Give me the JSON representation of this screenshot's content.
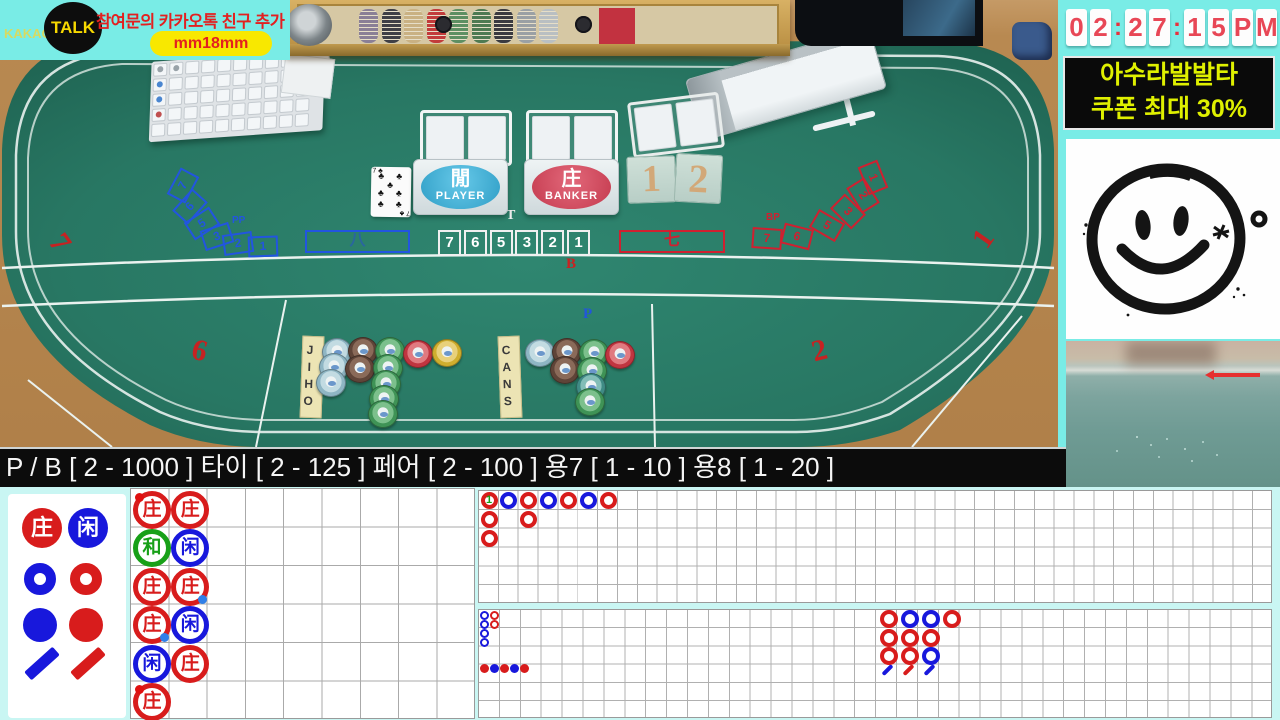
{
  "banner": {
    "kakao": "KAKAO",
    "talk": "TALK",
    "notice": "참여문의 카카오톡 친구 추가",
    "id_badge": "mm18mm"
  },
  "clock": {
    "chars": [
      "0",
      "2",
      ":",
      "2",
      "7",
      ":",
      "1",
      "5",
      "P",
      "M"
    ]
  },
  "promo": {
    "line1": "아수라발발타",
    "line2": "쿠폰 최대 30%"
  },
  "limits": {
    "text": "P / B [ 2 - 1000 ] 타이 [ 2 - 125 ] 페어 [ 2 - 100 ] 용7 [ 1 - 10 ] 용8 [ 1 - 20 ]"
  },
  "table": {
    "player": {
      "hanja": "閒",
      "label": "PLAYER"
    },
    "banker": {
      "hanja": "庄",
      "label": "BANKER"
    },
    "tie": {
      "label": "T",
      "numbers": [
        "7",
        "6",
        "5",
        "3",
        "2",
        "1"
      ]
    },
    "left_arc": {
      "label": "PP",
      "numbers": [
        "7",
        "6",
        "5",
        "3",
        "2",
        "1"
      ]
    },
    "right_arc": {
      "label": "BP",
      "numbers": [
        "1",
        "2",
        "3",
        "5",
        "6",
        "7"
      ]
    },
    "left_box": "八",
    "right_box": "七",
    "tiles": [
      "1",
      "2"
    ],
    "tags": [
      "JIHO",
      "CANS"
    ],
    "card": {
      "rank": "7",
      "suit": "♣"
    },
    "seats": [
      {
        "n": "7",
        "x": 52,
        "y": 226,
        "rot": 55
      },
      {
        "n": "6",
        "x": 192,
        "y": 334,
        "rot": 14
      },
      {
        "n": "2",
        "x": 812,
        "y": 334,
        "rot": -14
      },
      {
        "n": "1",
        "x": 976,
        "y": 222,
        "rot": -55
      }
    ],
    "region_labels": [
      {
        "n": "B",
        "x": 566,
        "y": 256,
        "color": "#cc2020"
      },
      {
        "n": "P",
        "x": 583,
        "y": 306,
        "color": "#2255dd"
      }
    ],
    "chips": [
      {
        "x": 337,
        "y": 352,
        "c": "lightblue"
      },
      {
        "x": 334,
        "y": 367,
        "c": "lightblue"
      },
      {
        "x": 331,
        "y": 383,
        "c": "lightblue"
      },
      {
        "x": 363,
        "y": 351,
        "c": "brown"
      },
      {
        "x": 360,
        "y": 369,
        "c": "brown"
      },
      {
        "x": 390,
        "y": 351,
        "c": "green"
      },
      {
        "x": 388,
        "y": 368,
        "c": "green"
      },
      {
        "x": 386,
        "y": 384,
        "c": "green"
      },
      {
        "x": 384,
        "y": 399,
        "c": "green"
      },
      {
        "x": 383,
        "y": 414,
        "c": "green"
      },
      {
        "x": 418,
        "y": 354,
        "c": "red"
      },
      {
        "x": 447,
        "y": 353,
        "c": "yellow"
      },
      {
        "x": 540,
        "y": 353,
        "c": "lightblue"
      },
      {
        "x": 567,
        "y": 352,
        "c": "brown"
      },
      {
        "x": 565,
        "y": 370,
        "c": "brown"
      },
      {
        "x": 594,
        "y": 353,
        "c": "green"
      },
      {
        "x": 592,
        "y": 371,
        "c": "green"
      },
      {
        "x": 591,
        "y": 387,
        "c": "teal"
      },
      {
        "x": 590,
        "y": 402,
        "c": "green"
      },
      {
        "x": 620,
        "y": 355,
        "c": "red"
      }
    ],
    "chip_colors": {
      "lightblue": [
        "#8fb6c4",
        "#c2dbe2"
      ],
      "brown": [
        "#5f4438",
        "#8a6a59"
      ],
      "green": [
        "#3f9356",
        "#7cc08c"
      ],
      "red": [
        "#c03540",
        "#e07a80"
      ],
      "yellow": [
        "#cfae2e",
        "#e8d07a"
      ],
      "teal": [
        "#3f8b85",
        "#82bdb7"
      ]
    }
  },
  "chip_case": {
    "stacks": [
      "#8a7f96",
      "#3f3f46",
      "#c9b183",
      "#c23b3b",
      "#5d8f62",
      "#4e7a52",
      "#3a3a40",
      "#9aa0a4",
      "#b9bfc2"
    ]
  },
  "scoreboard": {
    "colors": {
      "banker": "#d81c1c",
      "player": "#1818dc",
      "tie": "#18a018",
      "dot_blue": "#2f7fe8",
      "dot_red": "#e01010"
    },
    "legend": {
      "banker_char": "庄",
      "player_char": "闲"
    },
    "bead_road": {
      "symbols": {
        "B": "庄",
        "P": "闲",
        "T": "和"
      },
      "cells": [
        {
          "c": 0,
          "r": 0,
          "v": "B",
          "dot": "tl"
        },
        {
          "c": 0,
          "r": 1,
          "v": "T"
        },
        {
          "c": 0,
          "r": 2,
          "v": "B"
        },
        {
          "c": 0,
          "r": 3,
          "v": "B",
          "dot": "br"
        },
        {
          "c": 0,
          "r": 4,
          "v": "P"
        },
        {
          "c": 0,
          "r": 5,
          "v": "B",
          "dot": "tl"
        },
        {
          "c": 1,
          "r": 0,
          "v": "B"
        },
        {
          "c": 1,
          "r": 1,
          "v": "P"
        },
        {
          "c": 1,
          "r": 2,
          "v": "B",
          "dot": "br"
        },
        {
          "c": 1,
          "r": 3,
          "v": "P"
        },
        {
          "c": 1,
          "r": 4,
          "v": "B"
        }
      ]
    },
    "big_road": {
      "cells": [
        {
          "c": 0,
          "r": 0,
          "v": "B",
          "tie_count": "1"
        },
        {
          "c": 1,
          "r": 0,
          "v": "P"
        },
        {
          "c": 2,
          "r": 0,
          "v": "B"
        },
        {
          "c": 3,
          "r": 0,
          "v": "P"
        },
        {
          "c": 4,
          "r": 0,
          "v": "B"
        },
        {
          "c": 5,
          "r": 0,
          "v": "P"
        },
        {
          "c": 6,
          "r": 0,
          "v": "B"
        },
        {
          "c": 0,
          "r": 1,
          "v": "B"
        },
        {
          "c": 2,
          "r": 1,
          "v": "B"
        },
        {
          "c": 0,
          "r": 2,
          "v": "B"
        }
      ]
    },
    "big_eye_road": {
      "cells": [
        {
          "c": 0,
          "r": 0,
          "v": "P"
        },
        {
          "c": 0,
          "r": 1,
          "v": "P"
        },
        {
          "c": 0,
          "r": 2,
          "v": "P"
        },
        {
          "c": 0,
          "r": 3,
          "v": "P"
        },
        {
          "c": 1,
          "r": 0,
          "v": "B"
        },
        {
          "c": 1,
          "r": 1,
          "v": "B"
        }
      ]
    },
    "small_road": {
      "dots": [
        "B",
        "P",
        "B",
        "P",
        "B"
      ]
    },
    "three_road": {
      "rows": [
        [
          "B",
          "P",
          "P",
          "B"
        ],
        [
          "B",
          "B",
          "B"
        ],
        [
          "B",
          "B",
          "P"
        ]
      ],
      "slashes": [
        "P",
        "B",
        "P"
      ]
    }
  }
}
